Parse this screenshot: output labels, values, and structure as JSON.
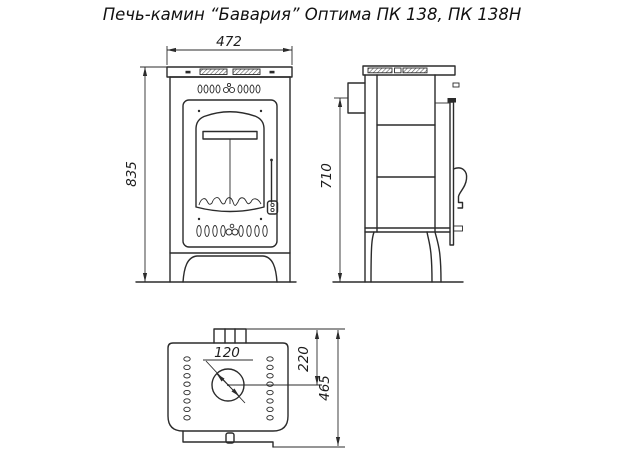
{
  "title": "Печь-камин “Бавария” Оптима ПК 138, ПК 138Н",
  "drawing": {
    "front_view": {
      "width": "472",
      "height": "835"
    },
    "side_view": {
      "flue_center_height": "710"
    },
    "top_view": {
      "flue_diameter": "120",
      "flue_center_offset": "220",
      "depth": "465"
    }
  },
  "colors": {
    "line": "#2b2b2b",
    "background": "#ffffff"
  }
}
